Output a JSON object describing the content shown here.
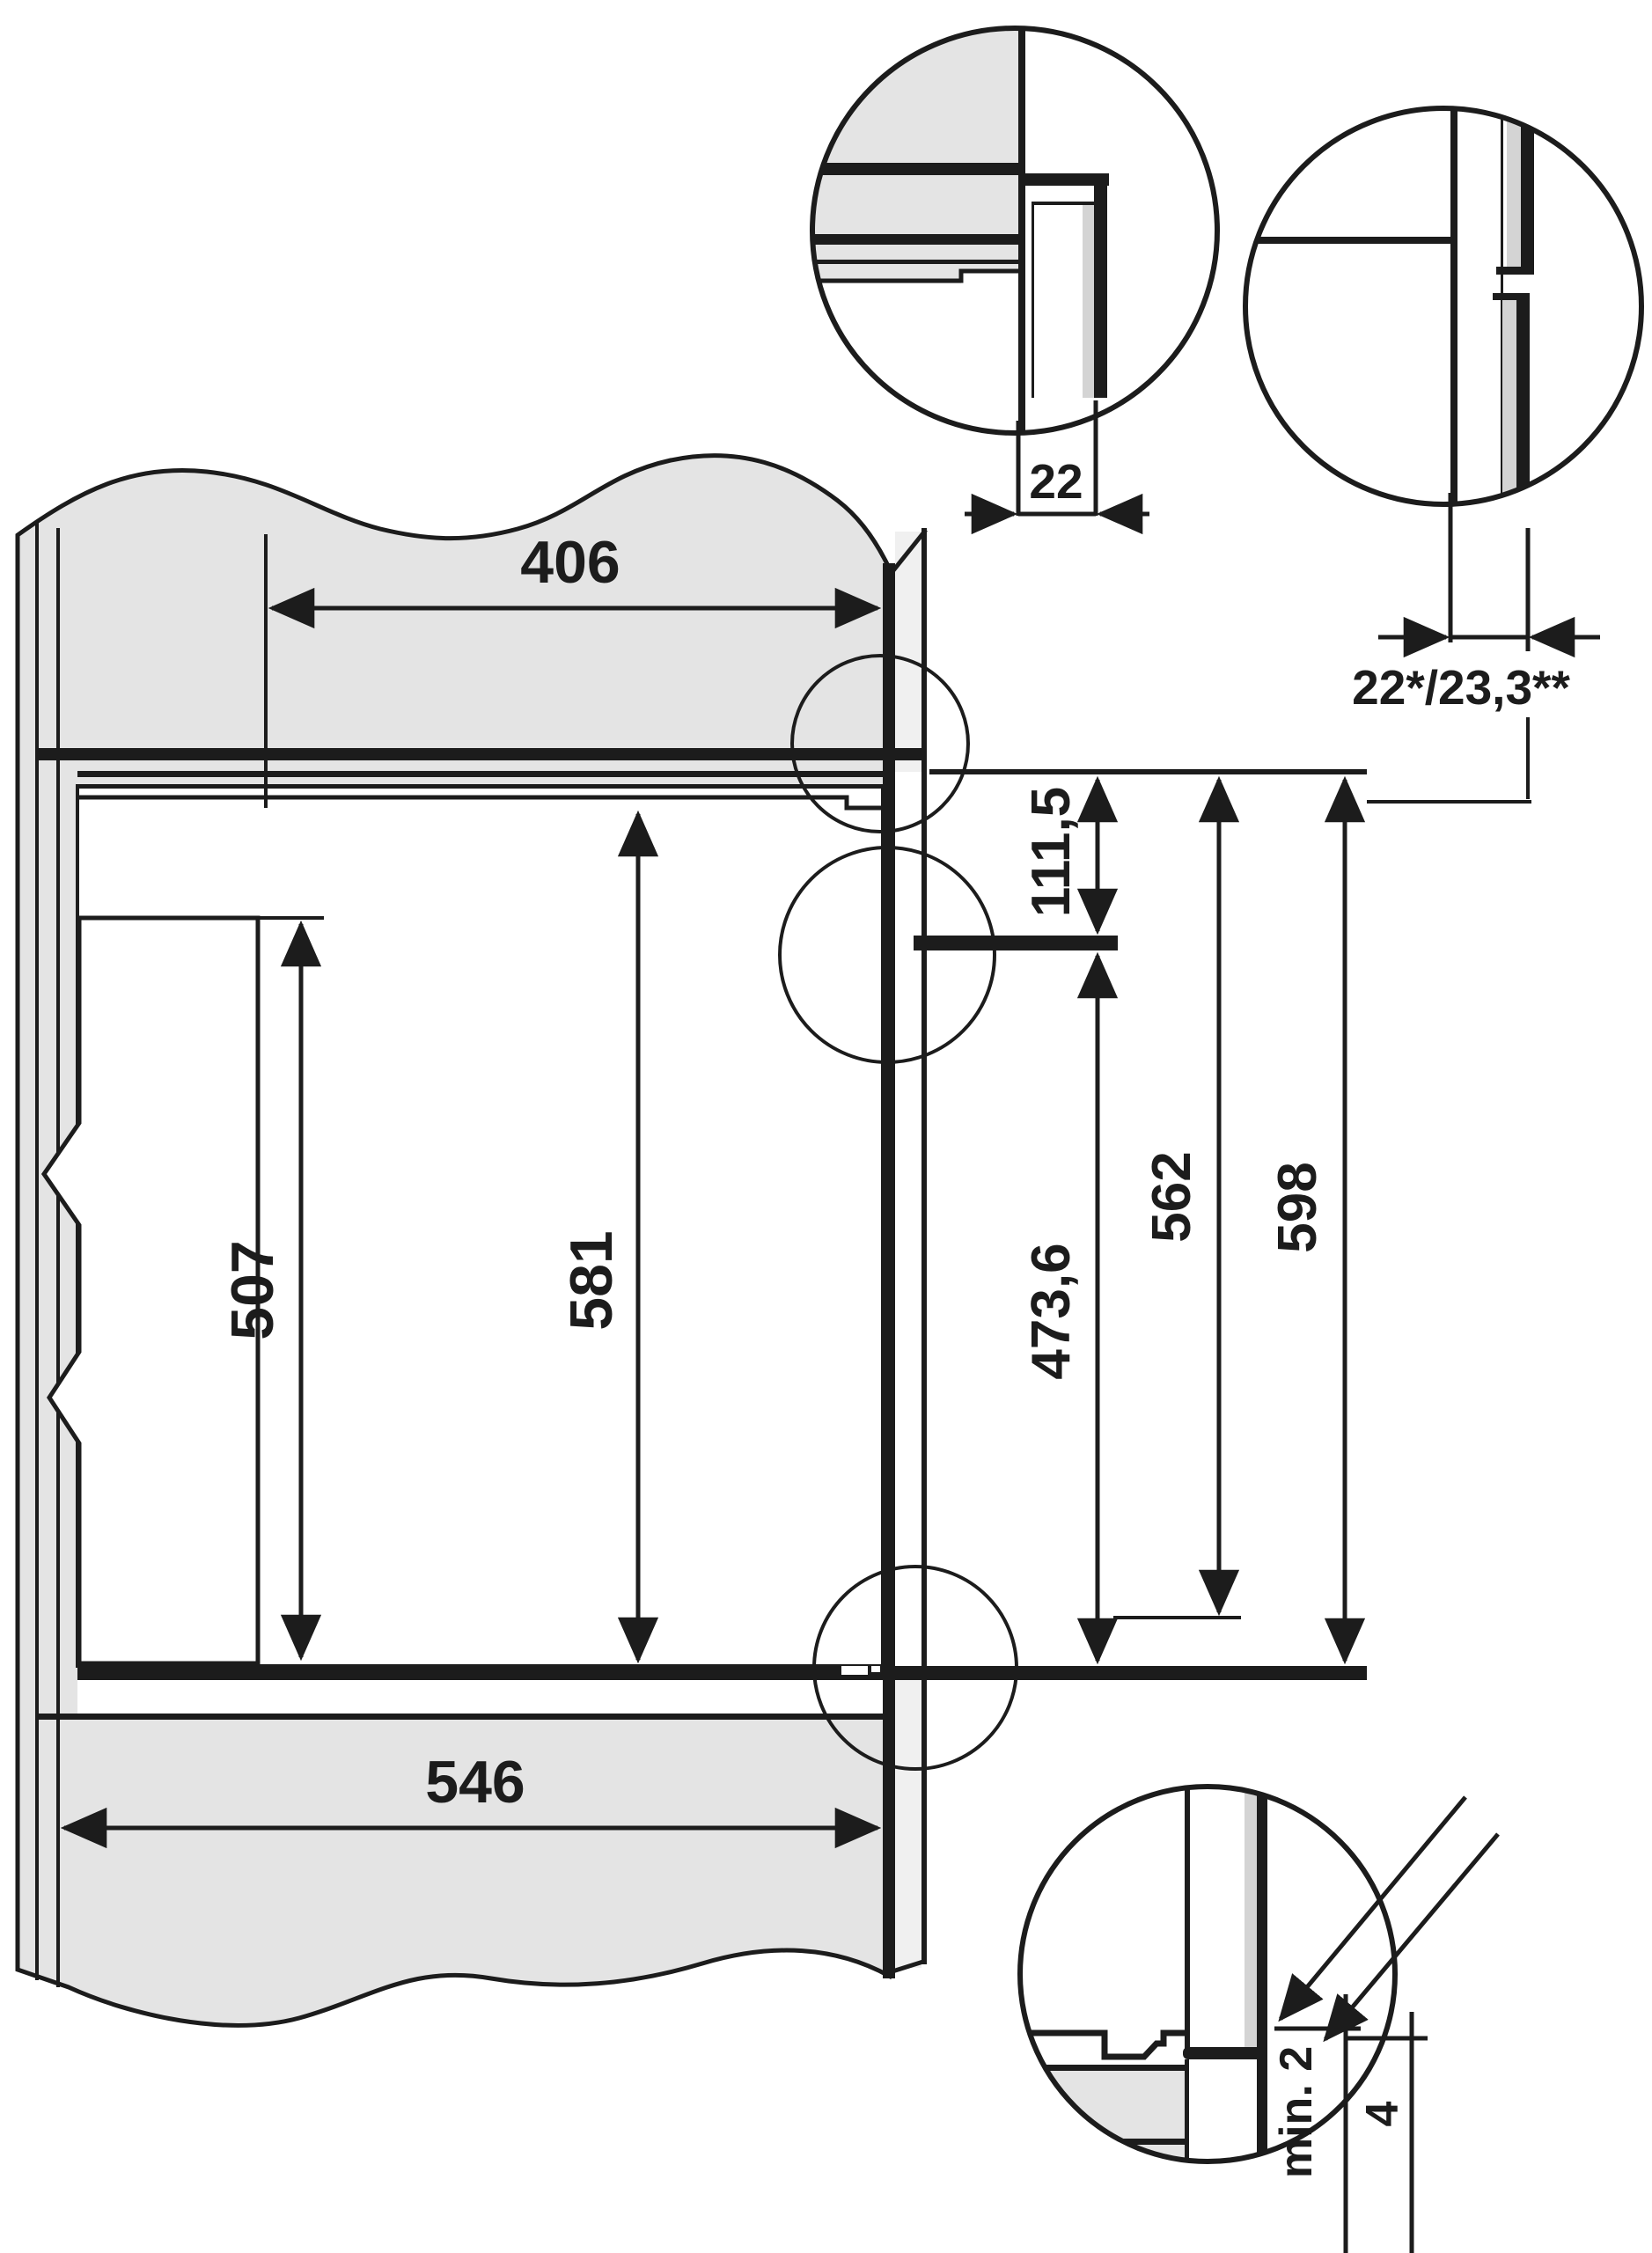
{
  "diagram": {
    "title": "built-in appliance niche installation drawing",
    "colors": {
      "line": "#1c1c1c",
      "cabinet_fill": "#e4e4e4",
      "front_strip_fill": "#f0f0f0",
      "board_sliver_fill": "#d4d4d4",
      "background": "#ffffff"
    },
    "labels": {
      "top_depth": "406",
      "inner_box_height": "507",
      "niche_height": "581",
      "bottom_depth": "546",
      "top_front_height": "111,5",
      "lower_front_height": "473,6",
      "inner_total_height": "562",
      "front_total_height": "598",
      "trim_gap": "22",
      "front_offset": "22*/23,3**",
      "bottom_clearance": "min. 2",
      "bottom_offset": "4"
    }
  }
}
